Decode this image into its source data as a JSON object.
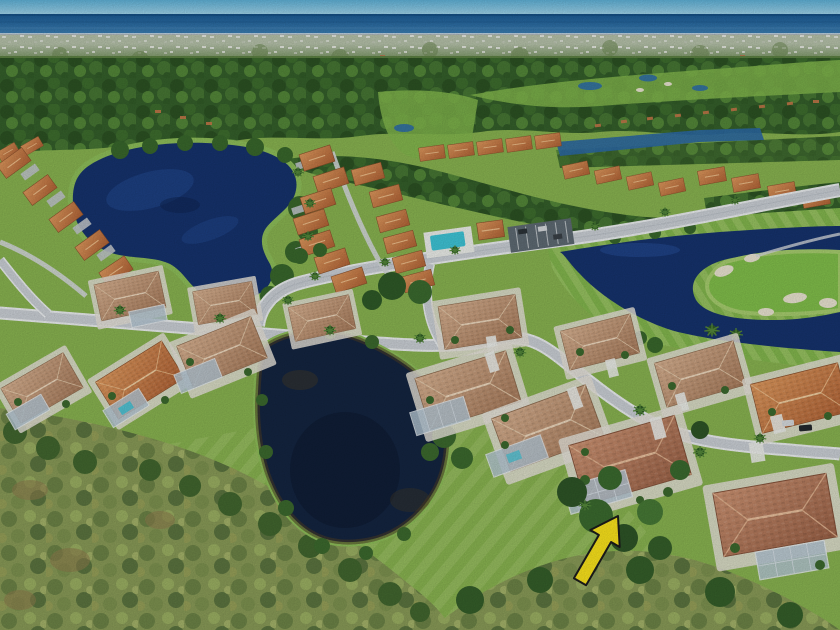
{
  "scene": {
    "type": "aerial photograph",
    "description": "Aerial drone photo of a Florida golf-course community: tile-roof single-family homes along curving streets, a large navy lake and a smaller dark pond, a golf green with sand bunkers beside a lake, a community pool with clubhouse and parking lot, a wild nature preserve in the foreground, distant suburbs and the ocean on the horizon. A yellow arrow annotation points to the subject property, a home with a screened lanai.",
    "annotation": {
      "marker": "yellow arrow",
      "meaning": "points to the subject property",
      "color": "#fce51c",
      "outline": "#1c1c1c"
    }
  },
  "colors": {
    "sky_top": "#62b4da",
    "sky_bottom": "#a5d6ec",
    "ocean": "#2e74ab",
    "ocean_horizon": "#1a5a94",
    "haze": "#b7c3ab",
    "distant_green": "#5d8243",
    "forest": "#35602b",
    "grass": "#8ab551",
    "grass_bright": "#97c25e",
    "fairway": "#84b84e",
    "golf_green": "#82c04b",
    "bunker_sand": "#ece6d3",
    "lake": "#16336e",
    "lake_light": "#2c59aa",
    "pond": "#142541",
    "pond_murk": "#4c3e24",
    "road": "#ccd1d7",
    "road_edge": "#eef1f3",
    "asphalt": "#5f6b74",
    "pool": "#3fc6d8",
    "deck": "#eef0ec",
    "roof_orange": "#c87a49",
    "roof_tan": "#c49a7c",
    "roof_red": "#b5765a",
    "lanai_screen": "#b7c9d6",
    "wall_white": "#e7e4da",
    "scrub": "#8a9c58",
    "scrub_dark": "#5c7540",
    "palm": "#2e5a26",
    "arrow": "#fce51c",
    "arrow_outline": "#1c1c1c"
  }
}
